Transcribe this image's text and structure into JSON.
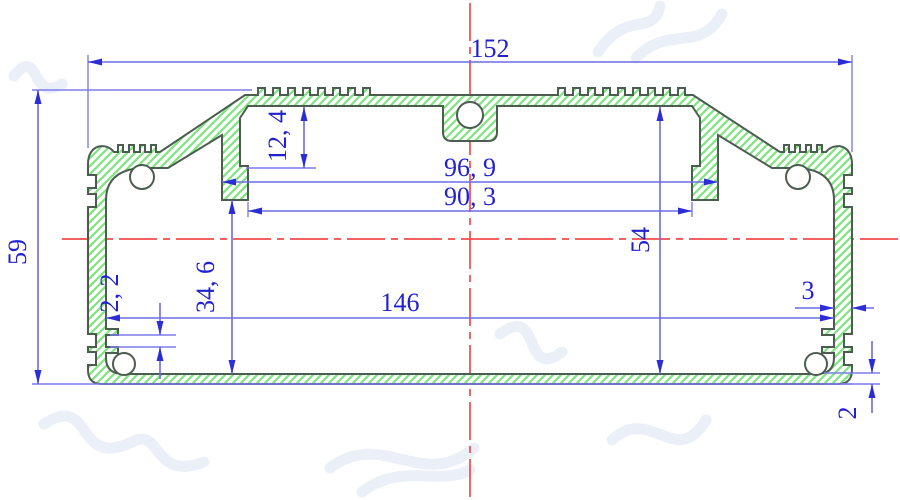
{
  "drawing": {
    "type": "aluminum-extrusion-enclosure-cross-section",
    "dimensions": {
      "overall_width": "152",
      "overall_height": "59",
      "top_recess_depth": "12, 4",
      "rail_inner_width": "96, 9",
      "boss_inner_width": "90, 3",
      "cavity_height": "54",
      "boss_to_floor": "34, 6",
      "slot_gap": "2, 2",
      "wall_inner_width": "146",
      "side_wall_thickness": "3",
      "bottom_wall_thickness": "2"
    },
    "colors": {
      "dimension_text_blue": "#2121cd",
      "dimension_line_blue": "#6b6be8",
      "centerline_red": "#f34b4b",
      "material_hatch_green": "#7de57d",
      "profile_outline": "#4d5c51",
      "background": "#ffffff"
    }
  }
}
